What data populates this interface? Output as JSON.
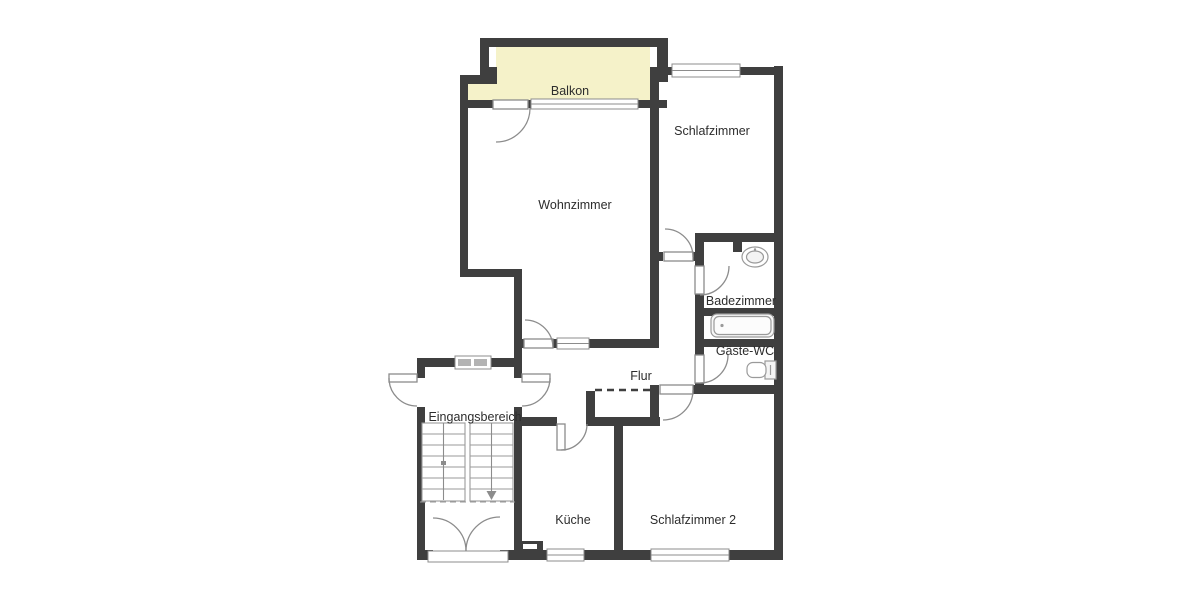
{
  "plan": {
    "type": "apartment-floor-plan",
    "rooms": {
      "balkon": {
        "label": "Balkon"
      },
      "schlafzimmer": {
        "label": "Schlafzimmer"
      },
      "wohnzimmer": {
        "label": "Wohnzimmer"
      },
      "badezimmer": {
        "label": "Badezimmer"
      },
      "gaeste_wc": {
        "label": "Gäste-WC"
      },
      "flur": {
        "label": "Flur"
      },
      "eingangsbereich": {
        "label": "Eingangsbereich"
      },
      "kueche": {
        "label": "Küche"
      },
      "schlafzimmer2": {
        "label": "Schlafzimmer 2"
      }
    },
    "colors": {
      "wall": "#3f3f3f",
      "balcony_fill": "#f5f2c9",
      "room_fill": "#ffffff",
      "fixture_stroke": "#8c8c8c",
      "label_text": "#2d2d2d",
      "background": "#ffffff"
    }
  }
}
